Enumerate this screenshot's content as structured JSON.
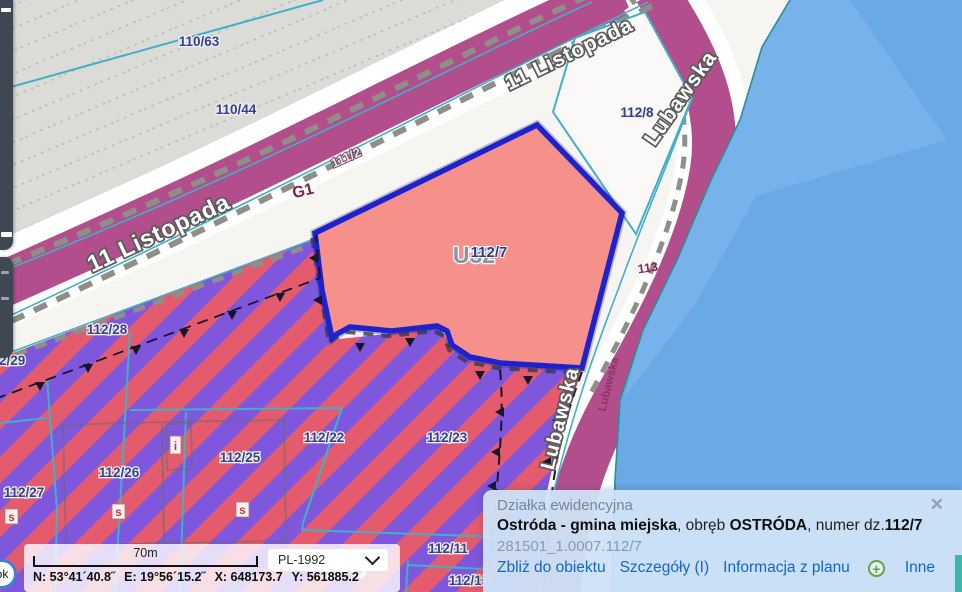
{
  "map": {
    "parcel_labels": {
      "l110_63": "110/63",
      "l110_44": "110/44",
      "l111_2": "111/2",
      "l112_8": "112/8",
      "l112_7": "112/7",
      "l113": "113",
      "l112_28": "112/28",
      "l112_29": "112/29",
      "l112_27": "112/27",
      "l112_26": "112/26",
      "l112_25": "112/25",
      "l112_22": "112/22",
      "l112_23": "112/23",
      "l112_11": "112/11",
      "l112_13": "112/13"
    },
    "street_labels": {
      "listopada": "11 Listopada",
      "lubawska": "Lubawska"
    },
    "zone_labels": {
      "g1": "G1",
      "u32": "U32",
      "pu": "1PU"
    },
    "markers": {
      "s": "s",
      "i": "i"
    },
    "colors": {
      "selected_fill": "#f5908a",
      "selected_border": "#1d22cc",
      "road": "#b24e8c",
      "water": "#69a9e6",
      "stripe_red": "#e45b6e",
      "stripe_purple": "#7e57dd",
      "boundary_teal": "#41b0c6"
    }
  },
  "statusbar": {
    "scale_label": "70m",
    "crs": "PL-1992",
    "coord_n": "N: 53°41´40.8˝",
    "coord_e": "E: 19°56´15.2˝",
    "coord_x": "X: 648173.7",
    "coord_y": "Y: 561885.2",
    "ok_label": "ok"
  },
  "popup": {
    "title": "Działka ewidencyjna",
    "close_glyph": "✕",
    "name_bold": "Ostróda - gmina miejska",
    "sep1": ", obręb ",
    "obreb_bold": "OSTRÓDA",
    "sep2": ", numer dz.",
    "parcel_bold": "112/7",
    "ident": "281501_1.0007.112/7",
    "links": {
      "zoom_to": "Zbliż do obiektu",
      "details": "Szczegóły (I)",
      "plan_info": "Informacja z planu",
      "plus_glyph": "+",
      "more": "Inne"
    }
  }
}
